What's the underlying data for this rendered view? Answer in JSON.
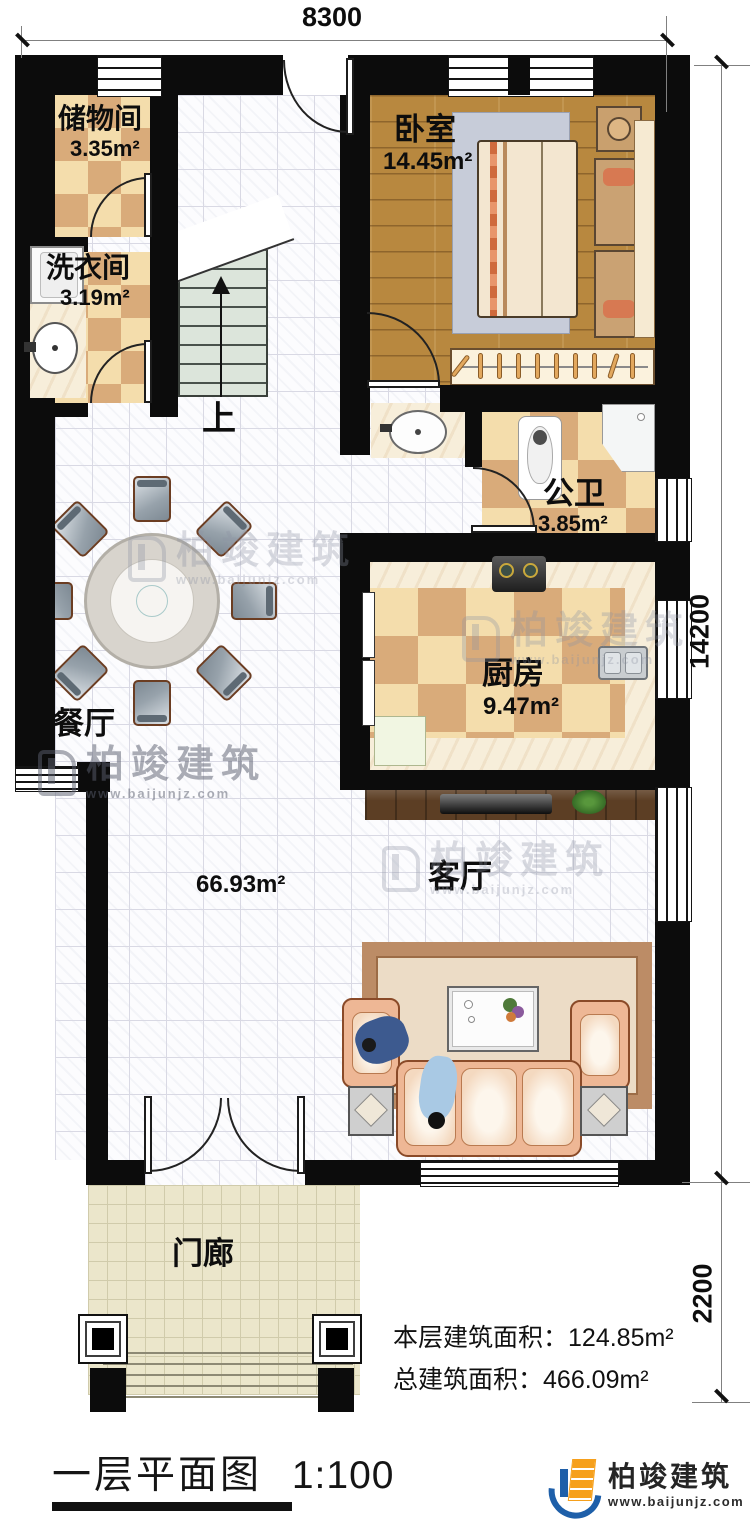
{
  "dimensions": {
    "width_top": "8300",
    "height_right": "14200",
    "porch_height_right": "2200"
  },
  "rooms": {
    "storage": {
      "name": "储物间",
      "area": "3.35m²"
    },
    "laundry": {
      "name": "洗衣间",
      "area": "3.19m²"
    },
    "bedroom": {
      "name": "卧室",
      "area": "14.45m²"
    },
    "bathroom": {
      "name": "公卫",
      "area": "3.85m²"
    },
    "kitchen": {
      "name": "厨房",
      "area": "9.47m²"
    },
    "dining": {
      "name": "餐厅"
    },
    "living": {
      "name": "客厅",
      "area": "66.93m²"
    },
    "porch": {
      "name": "门廊"
    },
    "stairs": {
      "direction_label": "上"
    }
  },
  "summary": {
    "floor_area_label": "本层建筑面积：",
    "floor_area_value": "124.85m²",
    "total_area_label": "总建筑面积：",
    "total_area_value": "466.09m²"
  },
  "title": {
    "text": "一层平面图",
    "scale": "1:100"
  },
  "brand": {
    "name": "柏竣建筑",
    "website": "www.baijunjz.com"
  },
  "colors": {
    "wall": "#0c0c0c",
    "checker_light": "#f4ddac",
    "checker_dark": "#d9ab7a",
    "wood_floor": "#b8883f",
    "accent_blue": "#1e5fa9",
    "accent_orange": "#f6a01c"
  }
}
